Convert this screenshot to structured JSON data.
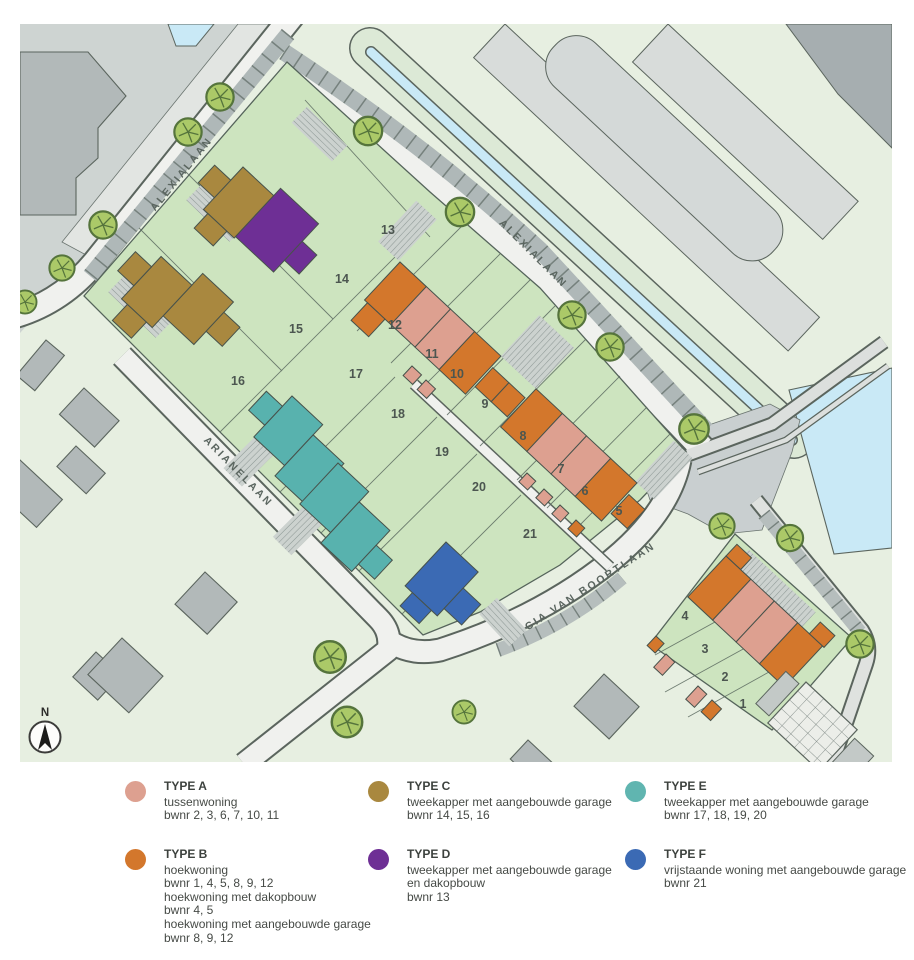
{
  "map": {
    "streets": [
      {
        "id": "alexialaan-left",
        "label": "ALEXIALAAN"
      },
      {
        "id": "alexialaan-top",
        "label": "ALEXIALAAN"
      },
      {
        "id": "arianelaan",
        "label": "ARIANELAAN"
      },
      {
        "id": "cia-van-boortlaan",
        "label": "CIA VAN BOORTLAAN"
      }
    ],
    "compass_label": "N",
    "plots": [
      {
        "n": "1",
        "x": 743,
        "y": 708
      },
      {
        "n": "2",
        "x": 725,
        "y": 681
      },
      {
        "n": "3",
        "x": 705,
        "y": 653
      },
      {
        "n": "4",
        "x": 685,
        "y": 620
      },
      {
        "n": "5",
        "x": 619,
        "y": 515
      },
      {
        "n": "6",
        "x": 585,
        "y": 495
      },
      {
        "n": "7",
        "x": 561,
        "y": 473
      },
      {
        "n": "8",
        "x": 523,
        "y": 440
      },
      {
        "n": "9",
        "x": 485,
        "y": 408
      },
      {
        "n": "10",
        "x": 457,
        "y": 378
      },
      {
        "n": "11",
        "x": 432,
        "y": 358
      },
      {
        "n": "12",
        "x": 395,
        "y": 329
      },
      {
        "n": "13",
        "x": 388,
        "y": 234
      },
      {
        "n": "14",
        "x": 342,
        "y": 283
      },
      {
        "n": "15",
        "x": 296,
        "y": 333
      },
      {
        "n": "16",
        "x": 238,
        "y": 385
      },
      {
        "n": "17",
        "x": 356,
        "y": 378
      },
      {
        "n": "18",
        "x": 398,
        "y": 418
      },
      {
        "n": "19",
        "x": 442,
        "y": 456
      },
      {
        "n": "20",
        "x": 479,
        "y": 491
      },
      {
        "n": "21",
        "x": 530,
        "y": 538
      }
    ]
  },
  "legend": {
    "items": [
      {
        "type": "TYPE A",
        "color": "#dda090",
        "lines": [
          "tussenwoning",
          "bwnr 2, 3, 6, 7, 10, 11"
        ]
      },
      {
        "type": "TYPE B",
        "color": "#d3772c",
        "lines": [
          "hoekwoning",
          "bwnr 1, 4, 5, 8, 9, 12",
          "hoekwoning met dakopbouw",
          "bwnr 4, 5",
          "hoekwoning met aangebouwde garage",
          "bwnr 8, 9, 12"
        ]
      },
      {
        "type": "TYPE C",
        "color": "#a9883f",
        "lines": [
          "tweekapper met aangebouwde garage",
          "bwnr 14, 15, 16"
        ]
      },
      {
        "type": "TYPE D",
        "color": "#6e2f95",
        "lines": [
          "tweekapper met aangebouwde garage",
          "en dakopbouw",
          "bwnr 13"
        ]
      },
      {
        "type": "TYPE E",
        "color": "#60b5b0",
        "lines": [
          "tweekapper met aangebouwde garage",
          "bwnr 17, 18, 19, 20"
        ]
      },
      {
        "type": "TYPE F",
        "color": "#3b6ab4",
        "lines": [
          "vrijstaande woning met aangebouwde garage",
          "bwnr 21"
        ]
      }
    ]
  },
  "colors": {
    "type_a": "#dda090",
    "type_b": "#d3772c",
    "type_c": "#a9883f",
    "type_d": "#6e2f95",
    "type_e": "#58b2ae",
    "type_f": "#3b6ab4",
    "block_green": "#cde4bf",
    "base_green": "#e7efe1",
    "water_blue": "#c9e9f6",
    "road_light": "#f0f1ee",
    "tree_green": "#abc968"
  }
}
